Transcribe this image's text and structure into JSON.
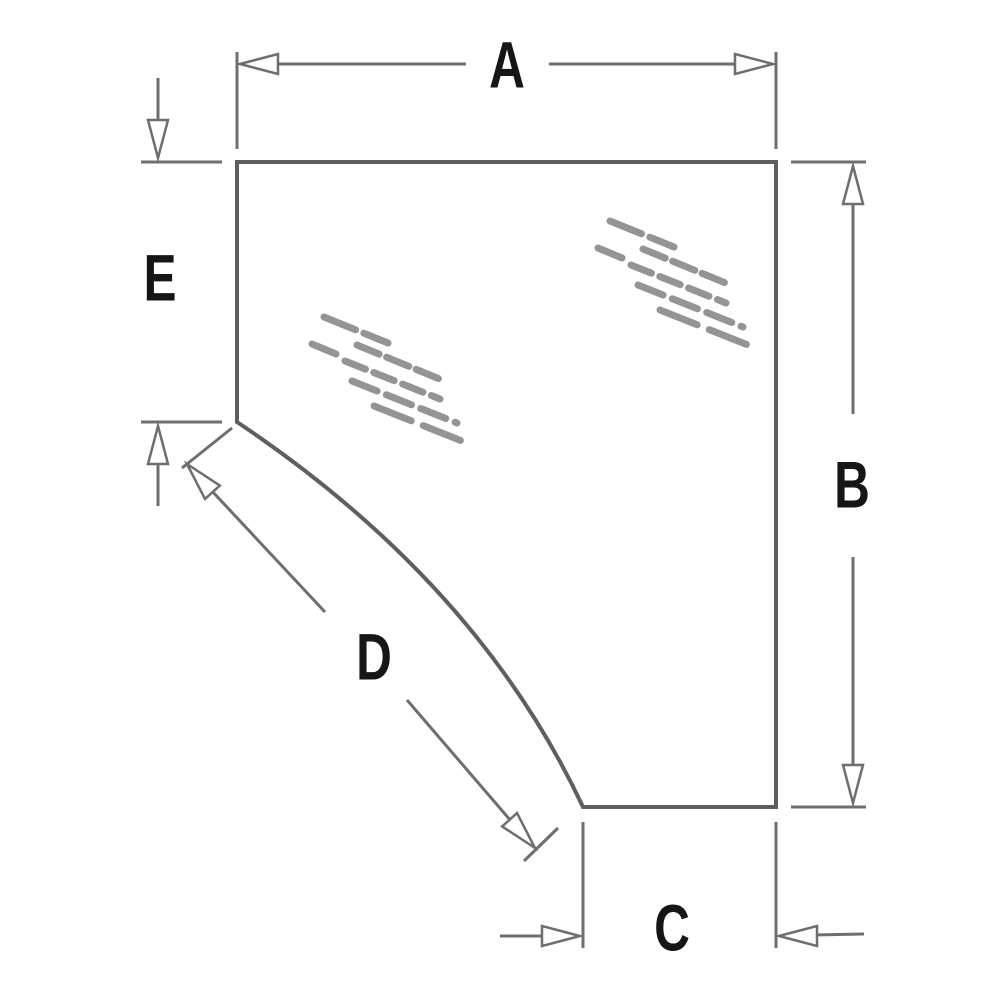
{
  "page": {
    "background": "#ffffff"
  },
  "diagram": {
    "description": "Corner glass panel technical dimension drawing with callouts A, B, C, D, E",
    "colors": {
      "outline": "#5f5f5f",
      "dimension": "#6e6e6e",
      "label": "#161616",
      "shine": "#949494",
      "arrow_fill": "#ffffff"
    },
    "panel_outline_path": "M 237 162 L 776 162 L 776 807 L 583 807 Q 478 583 237 422 Z",
    "labels": [
      {
        "id": "a",
        "text": "A",
        "x": 507,
        "y": 66
      },
      {
        "id": "b",
        "text": "B",
        "x": 852,
        "y": 486
      },
      {
        "id": "c",
        "text": "C",
        "x": 672,
        "y": 929
      },
      {
        "id": "d",
        "text": "D",
        "x": 374,
        "y": 658
      },
      {
        "id": "e",
        "text": "E",
        "x": 160,
        "y": 279
      }
    ],
    "dimension_segments": [
      {
        "name": "dim-a-extension-left",
        "x1": 237,
        "y1": 52,
        "x2": 237,
        "y2": 149
      },
      {
        "name": "dim-a-extension-right",
        "x1": 776,
        "y1": 52,
        "x2": 776,
        "y2": 149
      },
      {
        "name": "dim-a-line-left",
        "x1": 277,
        "y1": 64,
        "x2": 466,
        "y2": 64
      },
      {
        "name": "dim-a-line-right",
        "x1": 549,
        "y1": 64,
        "x2": 737,
        "y2": 64
      },
      {
        "name": "dim-b-tick-top",
        "x1": 791,
        "y1": 162,
        "x2": 866,
        "y2": 162
      },
      {
        "name": "dim-b-tick-bottom",
        "x1": 791,
        "y1": 807,
        "x2": 866,
        "y2": 807
      },
      {
        "name": "dim-b-line-upper",
        "x1": 853,
        "y1": 203,
        "x2": 853,
        "y2": 414
      },
      {
        "name": "dim-b-line-lower",
        "x1": 853,
        "y1": 557,
        "x2": 853,
        "y2": 766
      },
      {
        "name": "dim-c-extension-left",
        "x1": 583,
        "y1": 822,
        "x2": 583,
        "y2": 948
      },
      {
        "name": "dim-c-extension-right",
        "x1": 776,
        "y1": 822,
        "x2": 776,
        "y2": 948
      },
      {
        "name": "dim-c-tail-left",
        "x1": 500,
        "y1": 936,
        "x2": 546,
        "y2": 936
      },
      {
        "name": "dim-c-tail-right",
        "x1": 813,
        "y1": 935,
        "x2": 864,
        "y2": 934
      },
      {
        "name": "dim-e-stem-top",
        "x1": 158,
        "y1": 78,
        "x2": 158,
        "y2": 121
      },
      {
        "name": "dim-e-tick-top",
        "x1": 141,
        "y1": 162,
        "x2": 222,
        "y2": 162
      },
      {
        "name": "dim-e-stem-bottom",
        "x1": 158,
        "y1": 464,
        "x2": 158,
        "y2": 506
      },
      {
        "name": "dim-e-tick-bottom",
        "x1": 141,
        "y1": 422,
        "x2": 222,
        "y2": 422
      },
      {
        "name": "dim-d-tick-top",
        "x1": 232,
        "y1": 428,
        "x2": 182,
        "y2": 468
      },
      {
        "name": "dim-d-tick-bottom",
        "x1": 558,
        "y1": 828,
        "x2": 524,
        "y2": 861
      },
      {
        "name": "dim-d-line-upper",
        "x1": 211,
        "y1": 490,
        "x2": 325,
        "y2": 612
      },
      {
        "name": "dim-d-line-lower",
        "x1": 407,
        "y1": 700,
        "x2": 511,
        "y2": 821
      }
    ],
    "arrowheads": [
      {
        "name": "dim-a-arrow-left",
        "tip_x": 240,
        "tip_y": 64,
        "angle_deg": 180
      },
      {
        "name": "dim-a-arrow-right",
        "tip_x": 773,
        "tip_y": 64,
        "angle_deg": 0
      },
      {
        "name": "dim-b-arrow-top",
        "tip_x": 853,
        "tip_y": 166,
        "angle_deg": 270
      },
      {
        "name": "dim-b-arrow-bottom",
        "tip_x": 853,
        "tip_y": 803,
        "angle_deg": 90
      },
      {
        "name": "dim-c-arrow-left",
        "tip_x": 580,
        "tip_y": 936,
        "angle_deg": 0
      },
      {
        "name": "dim-c-arrow-right",
        "tip_x": 779,
        "tip_y": 936,
        "angle_deg": 180
      },
      {
        "name": "dim-e-arrow-top",
        "tip_x": 158,
        "tip_y": 158,
        "angle_deg": 90
      },
      {
        "name": "dim-e-arrow-bottom",
        "tip_x": 158,
        "tip_y": 426,
        "angle_deg": 270
      },
      {
        "name": "dim-d-arrow-top",
        "tip_x": 187,
        "tip_y": 464,
        "angle_deg": 228
      },
      {
        "name": "dim-d-arrow-bottom",
        "tip_x": 535,
        "tip_y": 848,
        "angle_deg": 48
      }
    ],
    "arrow_style": {
      "length": 38,
      "half_width": 10
    },
    "shine_marks": {
      "cluster_origins": [
        [
          598,
          218
        ],
        [
          312,
          314
        ]
      ],
      "strokes": [
        {
          "x1": 12,
          "y1": 3,
          "x2": 76,
          "y2": 29,
          "dash": "34 9"
        },
        {
          "x1": 0,
          "y1": 30,
          "x2": 24,
          "y2": 40,
          "dash": ""
        },
        {
          "x1": 45,
          "y1": 31,
          "x2": 130,
          "y2": 66,
          "dash": "24 8"
        },
        {
          "x1": 33,
          "y1": 47,
          "x2": 128,
          "y2": 85,
          "dash": "22 9"
        },
        {
          "x1": 40,
          "y1": 67,
          "x2": 145,
          "y2": 109,
          "dash": "27 10"
        },
        {
          "x1": 62,
          "y1": 92,
          "x2": 160,
          "y2": 131,
          "dash": "40 13"
        }
      ]
    }
  }
}
